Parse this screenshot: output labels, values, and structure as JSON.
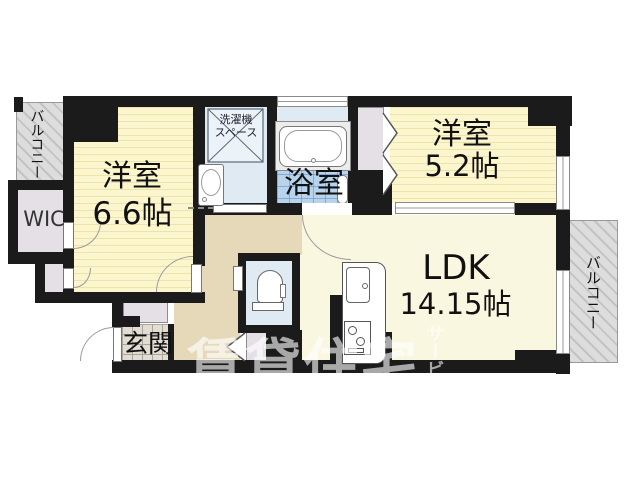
{
  "floorplan": {
    "balcony_left": {
      "label": "バルコニー"
    },
    "balcony_right": {
      "label": "バルコニー"
    },
    "bedroom_a": {
      "name": "洋室",
      "size": "6.6帖"
    },
    "bedroom_b": {
      "name": "洋室",
      "size": "5.2帖"
    },
    "ldk": {
      "name": "LDK",
      "size": "14.15帖"
    },
    "bath": {
      "label": "浴室"
    },
    "entrance": {
      "label": "玄関"
    },
    "wic": {
      "label": "WIC"
    },
    "laundry": {
      "line1": "洗濯機",
      "line2": "スペース"
    },
    "watermark": {
      "main": "賃貸住宅",
      "sub": "サービス"
    },
    "colors": {
      "wall": "#1b1b1b",
      "tatami": "#fcf6cf",
      "tatami-stripe": "#eee4ab",
      "ldk-floor": "#faf7e1",
      "corridor": "#e6d9ba",
      "water": "#e0eaf2",
      "bath-tile": "#b7d4ec",
      "balcony": "#dddddd",
      "closet": "#e4e0e5",
      "entry-tile": "#e2ddd3",
      "fixture-line": "#777777",
      "label": "#111111"
    }
  }
}
